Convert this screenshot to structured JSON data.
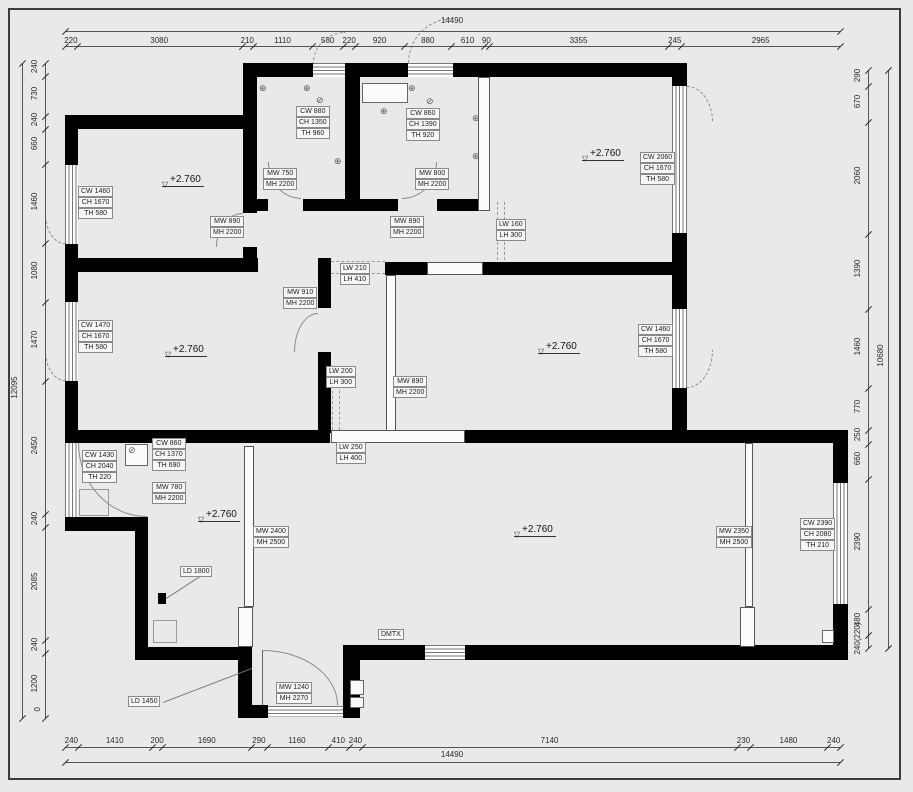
{
  "page": {
    "background": "#e9e9e9",
    "frame_color": "#3c3c3c",
    "wall_color": "#000000",
    "line_color": "#555555"
  },
  "dimensions": {
    "top": {
      "total": "14490",
      "segments": [
        "220",
        "3080",
        "210",
        "1110",
        "580",
        "220",
        "920",
        "880",
        "610",
        "90",
        "3355",
        "245",
        "2965"
      ],
      "values": [
        220,
        3080,
        210,
        1110,
        580,
        220,
        920,
        880,
        610,
        90,
        3355,
        245,
        2965
      ]
    },
    "bottom": {
      "total": "14490",
      "segments": [
        "240",
        "1410",
        "200",
        "1690",
        "290",
        "1160",
        "410",
        "240",
        "7140",
        "230",
        "1480",
        "240"
      ],
      "values": [
        240,
        1410,
        200,
        1690,
        290,
        1160,
        410,
        240,
        7140,
        230,
        1480,
        240
      ]
    },
    "left": {
      "total": "12095",
      "origin_label": "0",
      "segments": [
        "240",
        "730",
        "240",
        "660",
        "1460",
        "1080",
        "1470",
        "2450",
        "240",
        "2085",
        "240",
        "1200"
      ],
      "values": [
        240,
        730,
        240,
        660,
        1460,
        1080,
        1470,
        2450,
        240,
        2085,
        240,
        1200
      ]
    },
    "right": {
      "total": "10680",
      "segments": [
        "290",
        "670",
        "2060",
        "1390",
        "1460",
        "770",
        "250",
        "660",
        "2390",
        "480",
        "240(220)"
      ],
      "values": [
        290,
        670,
        2060,
        1390,
        1460,
        770,
        250,
        660,
        2390,
        480,
        240
      ]
    }
  },
  "tags": [
    {
      "x": 296,
      "y": 106,
      "lines": [
        "CW 880",
        "CH 1350",
        "TH 960"
      ]
    },
    {
      "x": 406,
      "y": 108,
      "lines": [
        "CW 860",
        "CH 1390",
        "TH 920"
      ]
    },
    {
      "x": 640,
      "y": 152,
      "lines": [
        "CW 2060",
        "CH 1670",
        "TH 580"
      ]
    },
    {
      "x": 78,
      "y": 186,
      "lines": [
        "CW 1460",
        "CH 1670",
        "TH 580"
      ]
    },
    {
      "x": 263,
      "y": 168,
      "lines": [
        "MW 750",
        "MH 2200"
      ]
    },
    {
      "x": 415,
      "y": 168,
      "lines": [
        "MW 800",
        "MH 2200"
      ]
    },
    {
      "x": 210,
      "y": 216,
      "lines": [
        "MW 890",
        "MH 2200"
      ]
    },
    {
      "x": 390,
      "y": 216,
      "lines": [
        "MW 890",
        "MH 2200"
      ]
    },
    {
      "x": 496,
      "y": 219,
      "lines": [
        "LW 160",
        "LH 300"
      ]
    },
    {
      "x": 340,
      "y": 263,
      "lines": [
        "LW 210",
        "LH 410"
      ]
    },
    {
      "x": 283,
      "y": 287,
      "lines": [
        "MW 910",
        "MH 2200"
      ]
    },
    {
      "x": 78,
      "y": 320,
      "lines": [
        "CW 1470",
        "CH 1670",
        "TH 580"
      ]
    },
    {
      "x": 638,
      "y": 324,
      "lines": [
        "CW 1460",
        "CH 1670",
        "TH 580"
      ]
    },
    {
      "x": 326,
      "y": 366,
      "lines": [
        "LW 200",
        "LH 300"
      ]
    },
    {
      "x": 393,
      "y": 376,
      "lines": [
        "MW 890",
        "MH 2200"
      ]
    },
    {
      "x": 336,
      "y": 442,
      "lines": [
        "LW 250",
        "LH 400"
      ]
    },
    {
      "x": 82,
      "y": 450,
      "lines": [
        "CW 1430",
        "CH 2040",
        "TH 220"
      ]
    },
    {
      "x": 152,
      "y": 438,
      "lines": [
        "CW 860",
        "CH 1370",
        "TH 690"
      ]
    },
    {
      "x": 152,
      "y": 482,
      "lines": [
        "MW 780",
        "MH 2200"
      ]
    },
    {
      "x": 253,
      "y": 526,
      "lines": [
        "MW 2400",
        "MH 2500"
      ]
    },
    {
      "x": 716,
      "y": 526,
      "lines": [
        "MW 2350",
        "MH 2500"
      ]
    },
    {
      "x": 800,
      "y": 518,
      "lines": [
        "CW 2390",
        "CH 2080",
        "TH 210"
      ]
    },
    {
      "x": 180,
      "y": 566,
      "lines": [
        "LD 1800"
      ]
    },
    {
      "x": 128,
      "y": 696,
      "lines": [
        "LD 1450"
      ]
    },
    {
      "x": 276,
      "y": 682,
      "lines": [
        "MW 1240",
        "MH 2270"
      ]
    },
    {
      "x": 378,
      "y": 629,
      "lines": [
        "DMTX"
      ]
    }
  ],
  "levels": {
    "text": "+2.760",
    "positions": [
      [
        162,
        174
      ],
      [
        582,
        148
      ],
      [
        165,
        344
      ],
      [
        538,
        341
      ],
      [
        198,
        509
      ],
      [
        514,
        524
      ]
    ]
  },
  "icons": {
    "target": "⊕",
    "drain": "⊘",
    "level_triangle": "▽"
  },
  "symbol_positions": {
    "target": [
      [
        259,
        84
      ],
      [
        303,
        84
      ],
      [
        380,
        107
      ],
      [
        408,
        84
      ],
      [
        472,
        114
      ],
      [
        472,
        152
      ],
      [
        334,
        157
      ]
    ],
    "drain": [
      [
        316,
        96
      ],
      [
        426,
        97
      ],
      [
        128,
        446
      ]
    ]
  }
}
